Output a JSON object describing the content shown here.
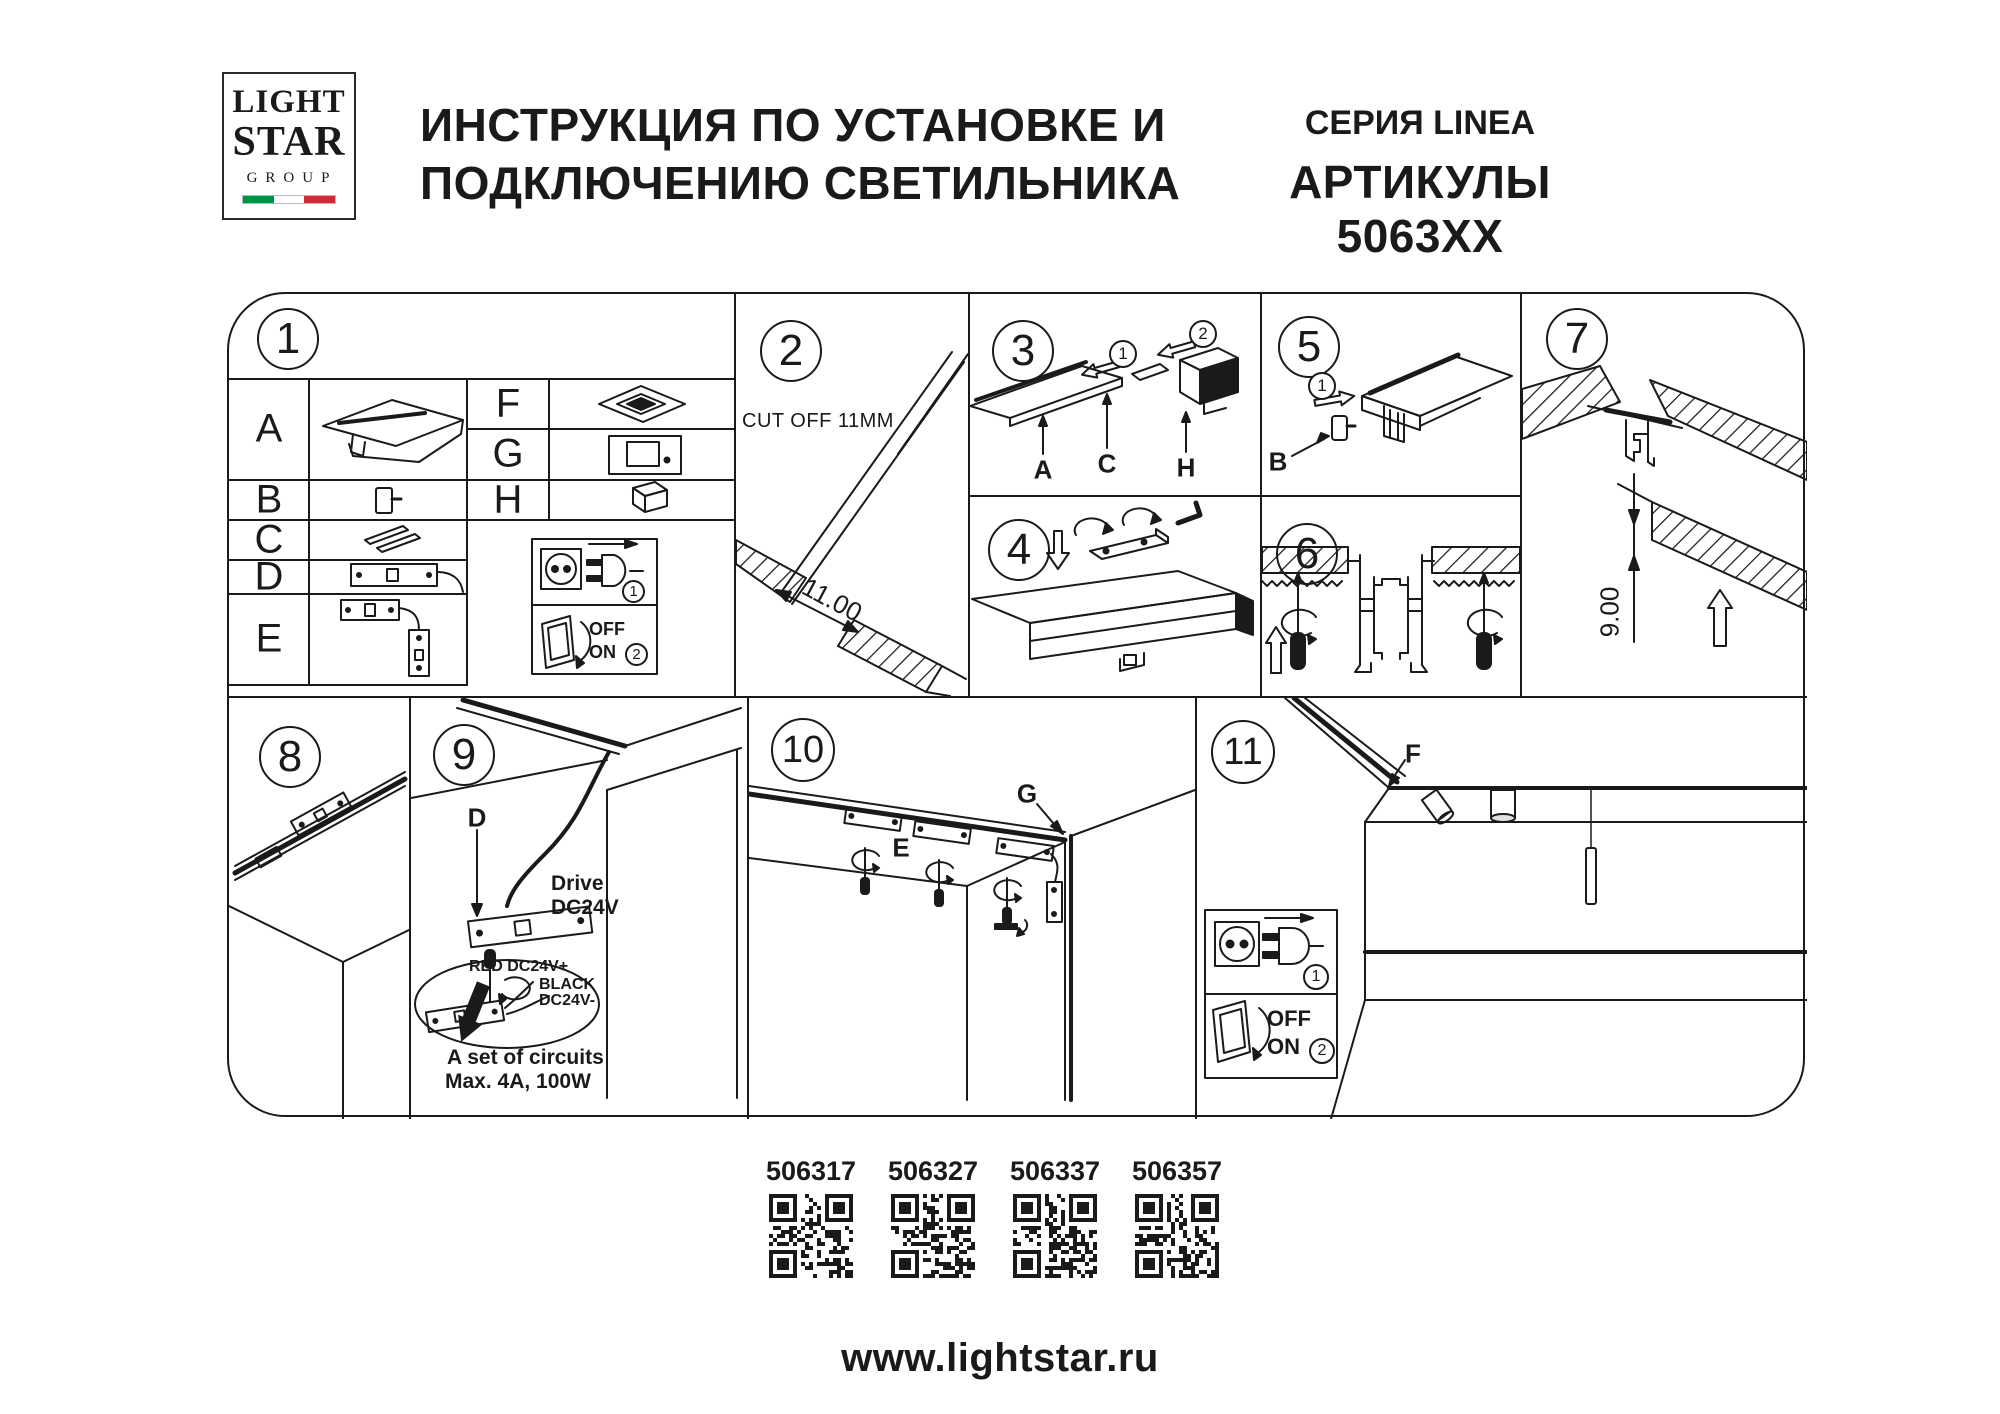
{
  "header": {
    "logo_line1": "LIGHT",
    "logo_line2": "STAR",
    "logo_line3": "GROUP",
    "title_line1": "ИНСТРУКЦИЯ ПО УСТАНОВКЕ И",
    "title_line2": "ПОДКЛЮЧЕНИЮ СВЕТИЛЬНИКА",
    "series": "СЕРИЯ LINEA",
    "articles_heading": "АРТИКУЛЫ 5063XX"
  },
  "panels": {
    "p1": {
      "number": "1",
      "letter_a": "A",
      "letter_b": "B",
      "letter_c": "C",
      "letter_d": "D",
      "letter_e": "E",
      "letter_f": "F",
      "letter_g": "G",
      "letter_h": "H",
      "plug_step": "1",
      "switch_step": "2",
      "off_label": "OFF",
      "on_label": "ON"
    },
    "p2": {
      "number": "2",
      "cut_off_note": "CUT OFF 11MM",
      "gap_dimension": "11.00"
    },
    "p3": {
      "number": "3",
      "step1": "1",
      "step2": "2",
      "label_a": "A",
      "label_c": "C",
      "label_h": "H"
    },
    "p4": {
      "number": "4"
    },
    "p5": {
      "number": "5",
      "step1": "1",
      "label_b": "B"
    },
    "p6": {
      "number": "6"
    },
    "p7": {
      "number": "7",
      "recess_dimension": "9.00"
    },
    "p8": {
      "number": "8"
    },
    "p9": {
      "number": "9",
      "label_d": "D",
      "driver_line1": "Drive",
      "driver_line2": "DC24V",
      "wire_red": "RED DC24V+",
      "wire_black_line1": "BLACK",
      "wire_black_line2": "DC24V-",
      "circuits_line1": "A set of circuits",
      "circuits_line2": "Max. 4A, 100W"
    },
    "p10": {
      "number": "10",
      "label_e": "E",
      "label_g": "G"
    },
    "p11": {
      "number": "11",
      "label_f": "F",
      "plug_step": "1",
      "switch_step": "2",
      "off_label": "OFF",
      "on_label": "ON"
    }
  },
  "articles": [
    {
      "code": "506317"
    },
    {
      "code": "506327"
    },
    {
      "code": "506337"
    },
    {
      "code": "506357"
    }
  ],
  "footer": {
    "website": "www.lightstar.ru"
  },
  "colors": {
    "ink": "#1a1a1a",
    "flag_green": "#009246",
    "flag_red": "#ce2b37"
  }
}
